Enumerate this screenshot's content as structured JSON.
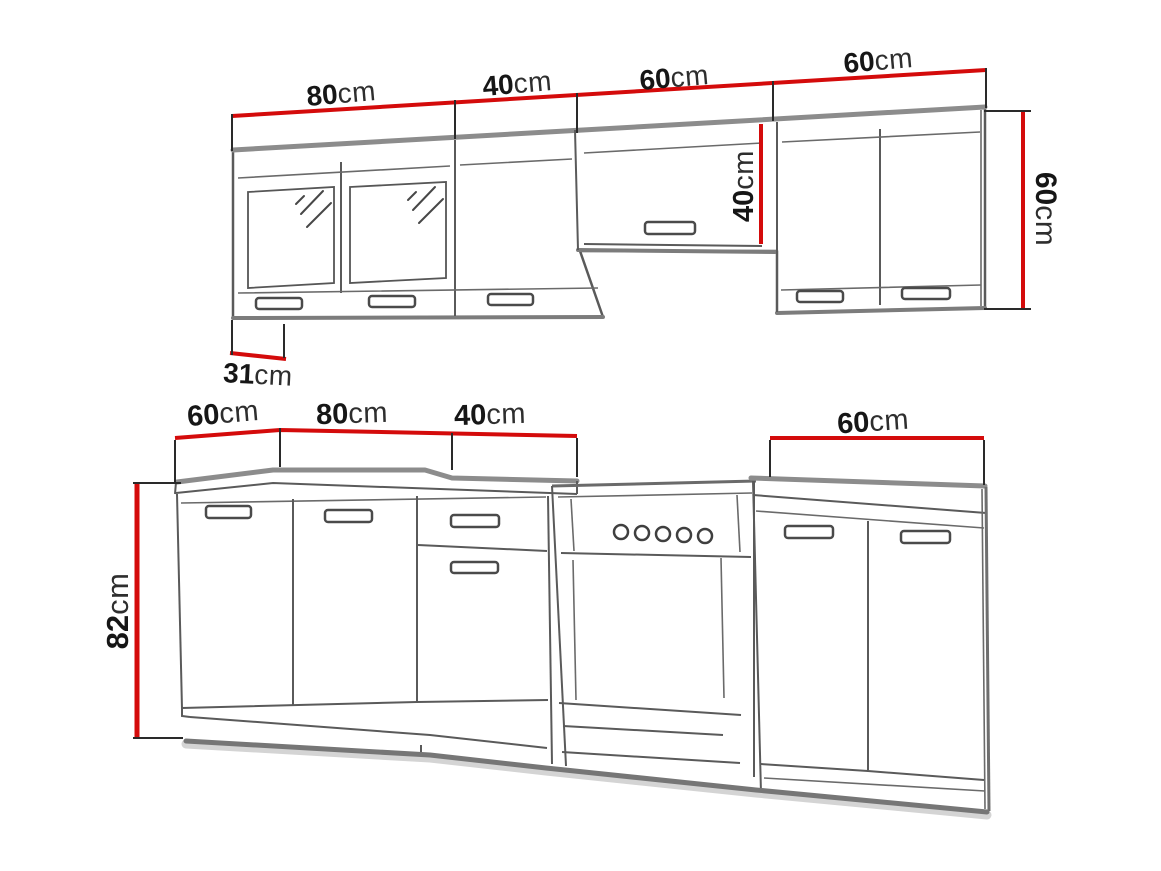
{
  "colors": {
    "dimension_line": "#d40b0b",
    "outline": "#5a5a5a",
    "edge_highlight": "#8c8c8c",
    "label_text": "#161616",
    "background": "#ffffff"
  },
  "labels": {
    "upper_widths": [
      {
        "value": "80",
        "unit": "cm"
      },
      {
        "value": "40",
        "unit": "cm"
      },
      {
        "value": "60",
        "unit": "cm"
      },
      {
        "value": "60",
        "unit": "cm"
      }
    ],
    "upper_side_depth": {
      "value": "31",
      "unit": "cm"
    },
    "hood_opening_height": {
      "value": "40",
      "unit": "cm"
    },
    "upper_cabinet_height": {
      "value": "60",
      "unit": "cm"
    },
    "lower_widths": [
      {
        "value": "60",
        "unit": "cm"
      },
      {
        "value": "80",
        "unit": "cm"
      },
      {
        "value": "40",
        "unit": "cm"
      },
      {
        "value": "60",
        "unit": "cm"
      }
    ],
    "base_cabinet_height": {
      "value": "82",
      "unit": "cm"
    }
  }
}
